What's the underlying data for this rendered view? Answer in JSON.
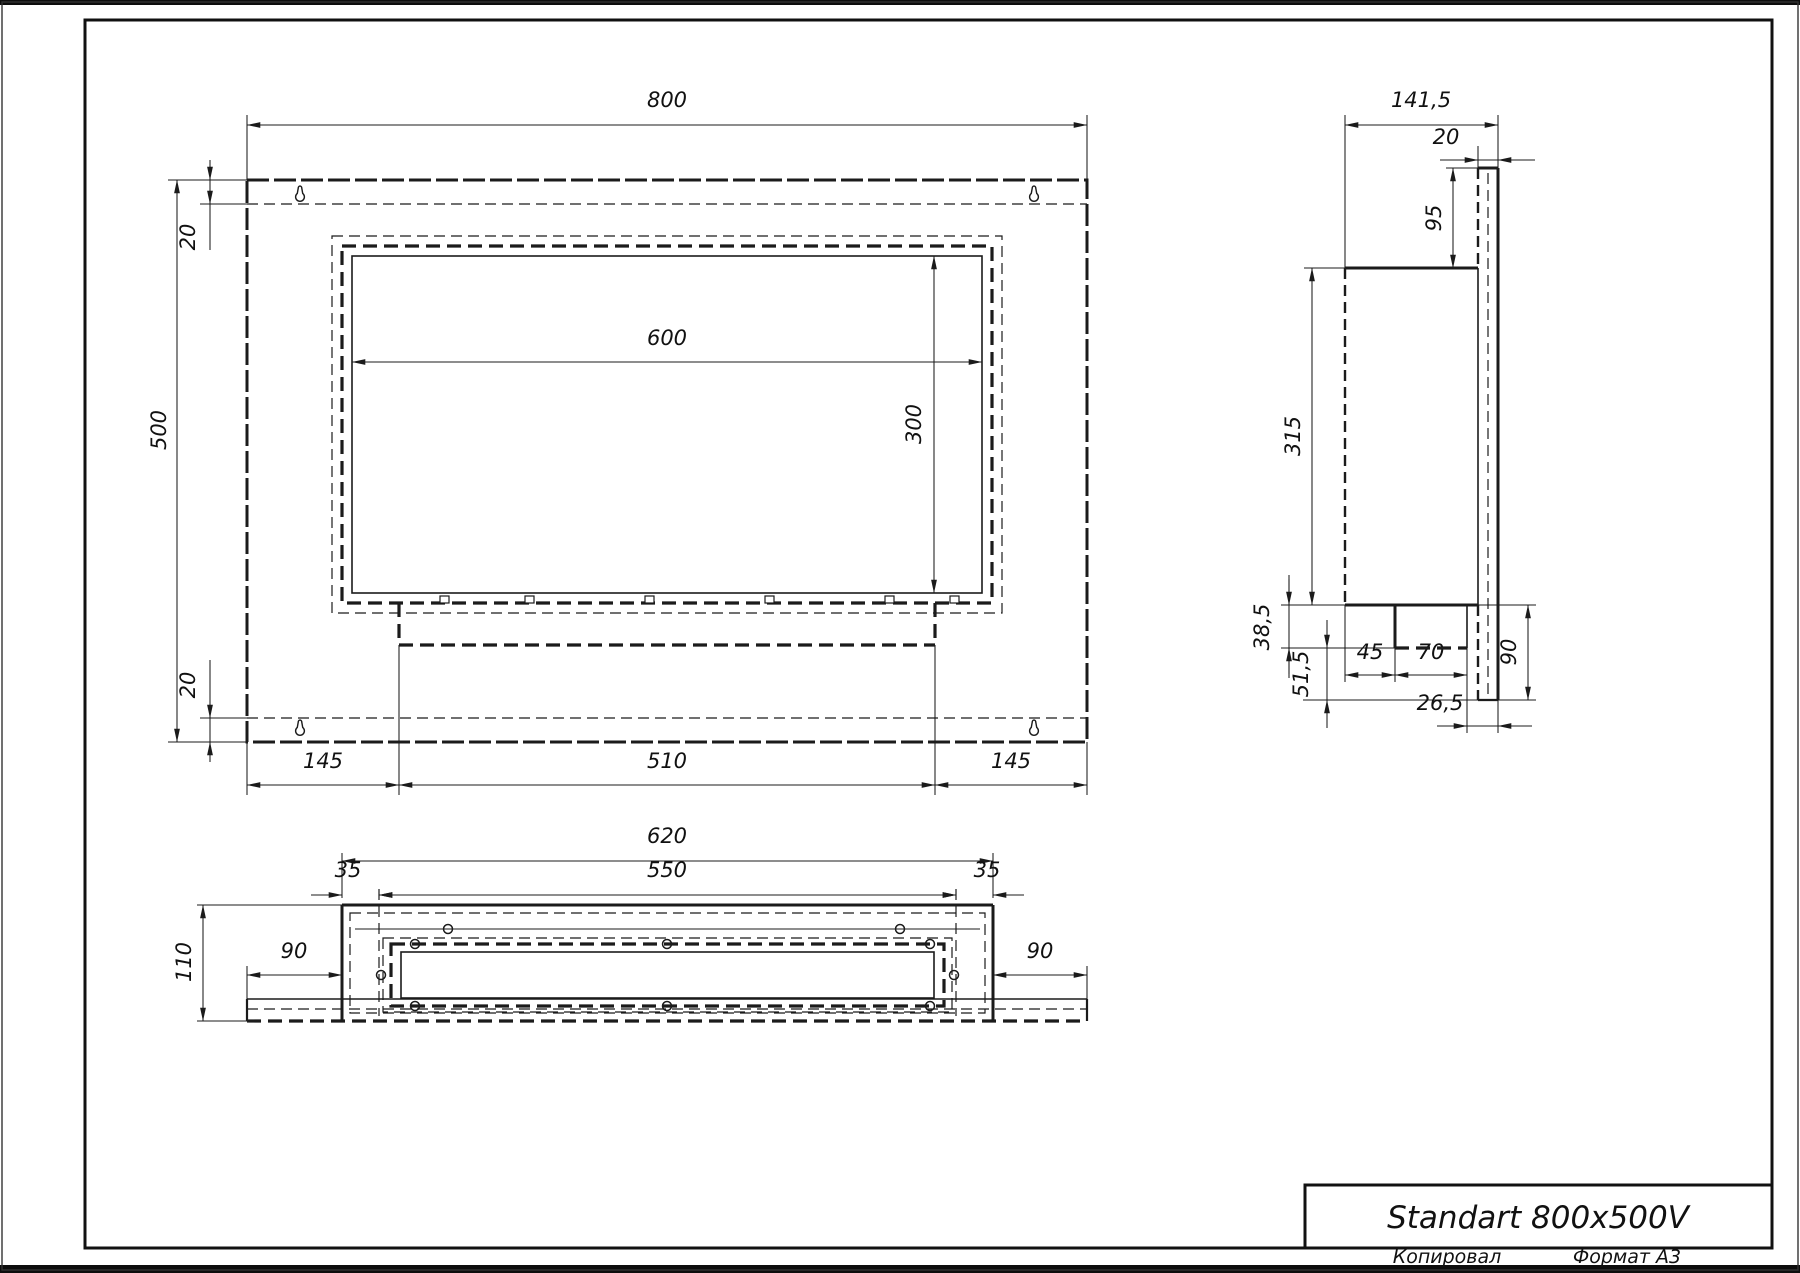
{
  "front_view": {
    "width": "800",
    "height": "500",
    "flange_top": "20",
    "flange_bottom": "20",
    "opening_width": "600",
    "opening_height": "300",
    "margin_left": "145",
    "tray_width": "510",
    "margin_right": "145"
  },
  "side_view": {
    "total_depth": "141,5",
    "plate_thickness": "20",
    "top_offset": "95",
    "body_height": "315",
    "tray_drop": "38,5",
    "bottom_drop": "51,5",
    "front_inset": "45",
    "tray_depth": "70",
    "rear_inset": "26,5",
    "below_body": "90"
  },
  "bottom_view": {
    "body_width": "620",
    "margin_left": "35",
    "opening_width": "550",
    "margin_right": "35",
    "depth": "110",
    "flange_left": "90",
    "flange_right": "90"
  },
  "title_block": {
    "title": "Standart 800x500V",
    "copied_by_label": "Копировал",
    "format_label": "Формат А3"
  }
}
